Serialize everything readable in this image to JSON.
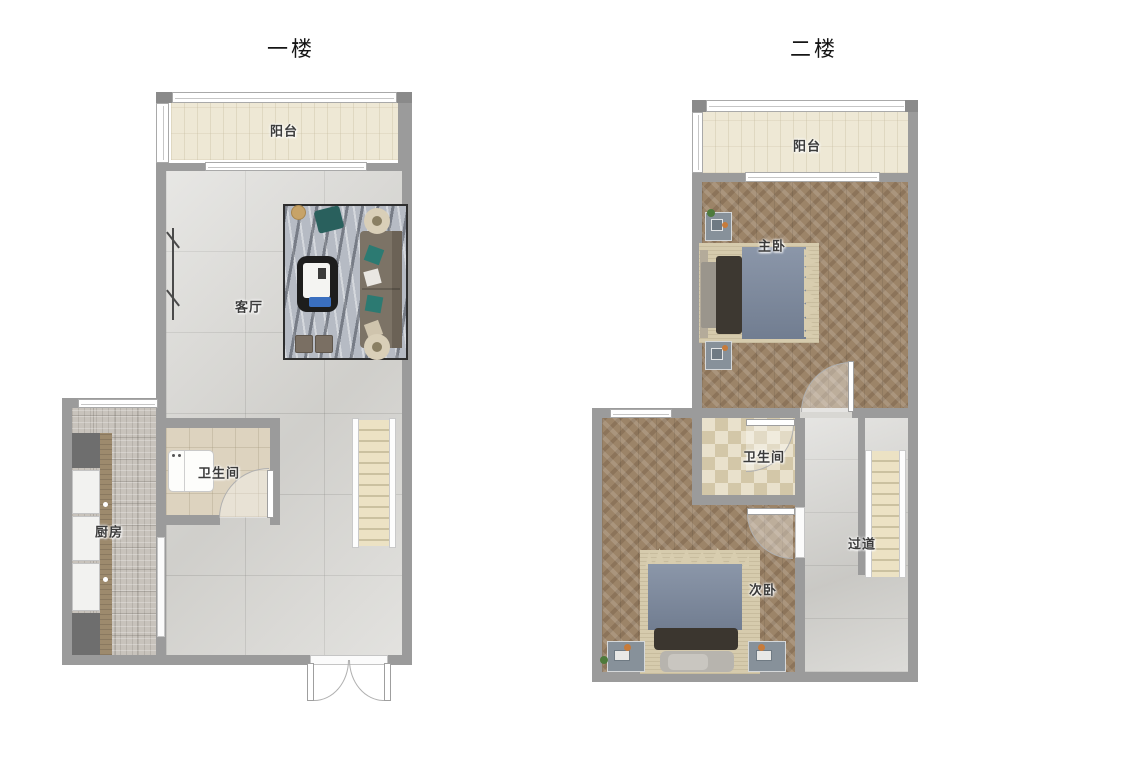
{
  "document": {
    "kind": "floor-plan",
    "floor_count": 2
  },
  "floors": [
    {
      "title": "一楼",
      "rooms": [
        {
          "id": "balcony-1f",
          "label": "阳台"
        },
        {
          "id": "living-room",
          "label": "客厅"
        },
        {
          "id": "bathroom-1f",
          "label": "卫生间"
        },
        {
          "id": "kitchen",
          "label": "厨房"
        }
      ]
    },
    {
      "title": "二楼",
      "rooms": [
        {
          "id": "balcony-2f",
          "label": "阳台"
        },
        {
          "id": "master-bedroom",
          "label": "主卧"
        },
        {
          "id": "bathroom-2f",
          "label": "卫生间"
        },
        {
          "id": "secondary-bedroom",
          "label": "次卧"
        },
        {
          "id": "hallway",
          "label": "过道"
        }
      ]
    }
  ],
  "palette": {
    "wall": "#9b9b9b",
    "balcony_floor": "#eee8d5",
    "living_marble": "#d8d7d3",
    "kitchen_floor": "#c8c3bc",
    "bath1_floor": "#ddd3bf",
    "bath2_checker": "#d3c7a8",
    "wood_herringbone": "#9c8468",
    "hallway_marble": "#d4d3cf",
    "stair_tread": "#ece2c4",
    "bed_blanket": "#7b889d",
    "bed_rug": "#d6cbad",
    "window_white": "#ffffff"
  }
}
